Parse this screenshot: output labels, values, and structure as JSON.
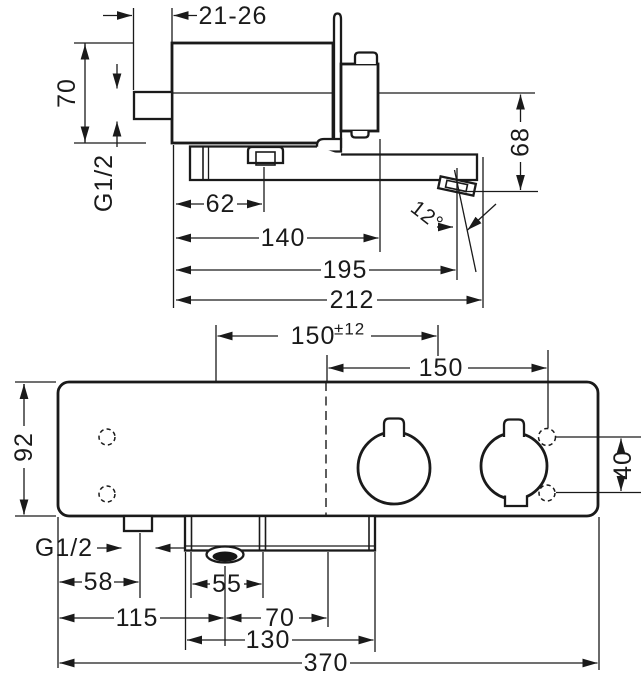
{
  "drawing": {
    "background": "#ffffff",
    "line_color": "#1a1a1a",
    "views": {
      "side": {
        "dims": {
          "fastening_depth": "21-26",
          "body_height": "70",
          "connection_thread": "G1/2",
          "slider_offset": "62",
          "handle_projection": "140",
          "outlet_projection": "195",
          "spout_projection": "212",
          "outlet_height": "68",
          "spout_angle": "12°"
        }
      },
      "front": {
        "dims": {
          "connection_spacing": "150",
          "connection_tolerance": "±12",
          "port_offset": "150",
          "body_height": "92",
          "port_spacing": "40",
          "connection_thread": "G1/2",
          "inlet_offset": "58",
          "spout_width": "55",
          "aerator_offset": "115",
          "aerator_to_center": "70",
          "base_width": "130",
          "body_width": "370"
        }
      }
    }
  }
}
